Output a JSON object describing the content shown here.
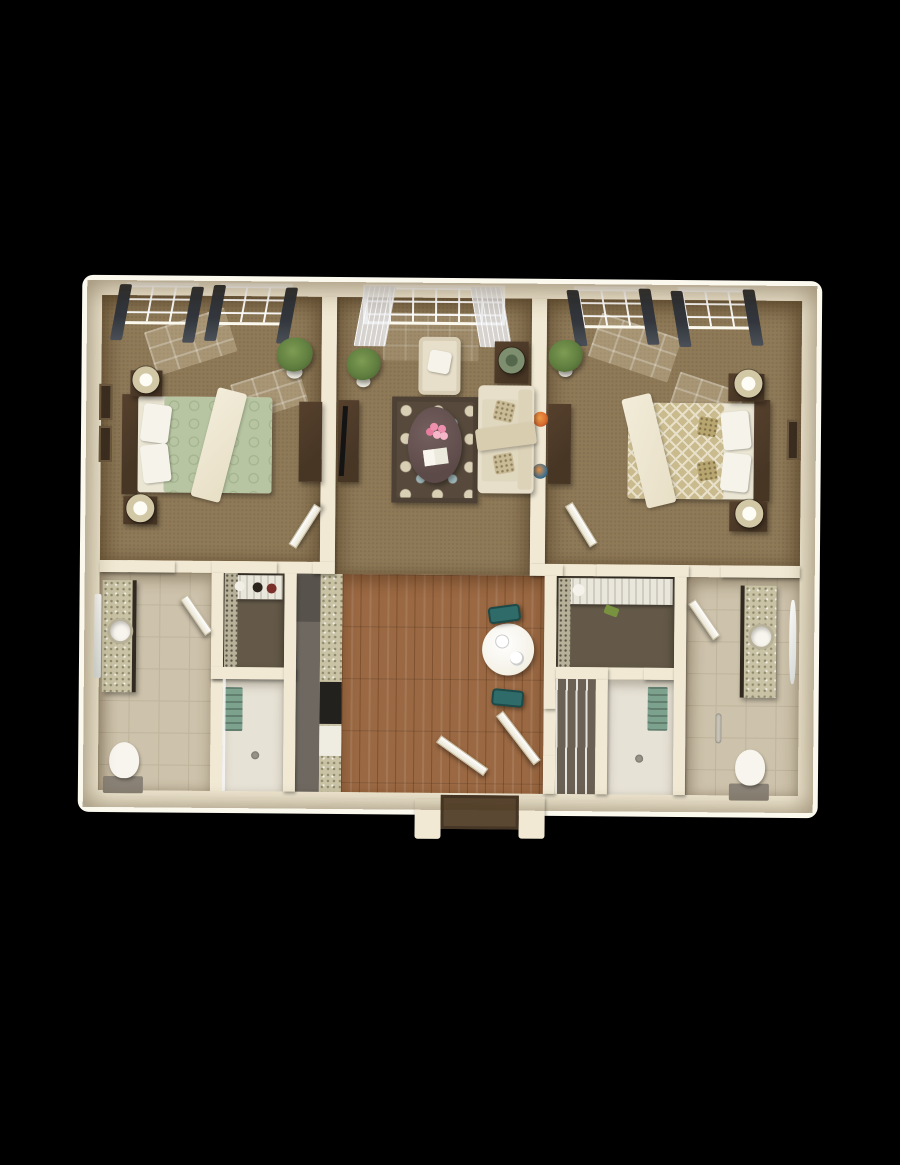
{
  "scene": {
    "type": "3d-overhead-floor-plan-render",
    "description": "Top-down 3D rendering of a two-bedroom, two-bath apartment on a black background: two carpeted bedrooms flank a central living room; below are two bath/closet suites flanking a galley kitchen with wood-floor dining area and front entry",
    "background_color": "#000000",
    "visible_text": []
  },
  "palette": {
    "wall": "#f1e9d3",
    "wall_rim": "#fbf8ee",
    "carpet": "#8f7a58",
    "tile": "#cdc2ab",
    "tile_line": "#bfb49c",
    "wood": "#9a6842",
    "wood_dark": "#7f522f",
    "closet_floor": "#645948",
    "shower_floor": "#e7e2d6",
    "counter_dark": "#6e6860",
    "fridge": "#57524b",
    "granite": "#c9c2a4",
    "granite_dot": "#8f8a6d",
    "cooktop": "#23211e",
    "appliance": "#efece1",
    "bed_green": "#b7c5a2",
    "bed_green_dot": "#a3b38c",
    "bed_tan": "#cabb8e",
    "bed_tan_line": "#e8e0c9",
    "mattress": "#ebe6d4",
    "pillow": "#f6f4ea",
    "throw_cream": "#e8dfc6",
    "dark_wood": "#483625",
    "lamp_shade": "#d3c8a6",
    "rug_base": "#574a3c",
    "rug_cream": "#d9cfb4",
    "rug_blue": "#9fb7ba",
    "rug_border": "#4c4134",
    "sofa_cream": "#e7dfca",
    "cushion": "#e0d7bf",
    "teal": "#2f6b68",
    "table_white": "#f4f1e6",
    "doormat": "#5b4833",
    "towel": "#7ca28e",
    "tank": "#8a8276",
    "porcelain": "#f7f5ed",
    "plant": "#5e7c3e",
    "pot": "#eceadf",
    "sky_top": "#cfe6f2",
    "sky_bot": "#eff8fc",
    "curtain_dark": "#34383e",
    "sheer": "rgba(233,234,238,0.8)",
    "art_a": "#d86a2e",
    "art_b": "#3e6f8e",
    "flower": "#ef8fae",
    "glass": "rgba(255,255,255,0.75)"
  },
  "rooms": [
    {
      "id": "bedroom-left",
      "floor": "carpet",
      "furniture": [
        "queen bed with sage-green patterned duvet, white pillows, cream throw, dark headboard",
        "two dark-wood nightstands with cream drum lamps",
        "two wall frames",
        "potted plant",
        "dresser",
        "two windows with dark curtain panels",
        "swing door"
      ]
    },
    {
      "id": "living-room",
      "floor": "carpet",
      "furniture": [
        "wide window with sheer curtains",
        "cream armchair with pillow",
        "yucca plant",
        "side table with green lamp",
        "media console with flat TV",
        "brown damask area rug (cream and blue motifs)",
        "oval dark coffee table with pink flowers and open book",
        "cream sofa with two patterned pillows and tan throw",
        "two round wall artworks"
      ]
    },
    {
      "id": "bedroom-right",
      "floor": "carpet",
      "furniture": [
        "queen bed with tan trellis-pattern duvet, white pillows, accent pillows, cream throw, dark headboard on right wall",
        "two nightstands with cream drum lamps",
        "potted plant",
        "dresser",
        "wall frame",
        "two windows with dark curtain panels",
        "swing door"
      ]
    },
    {
      "id": "bathroom-left",
      "floor": "tile",
      "furniture": [
        "granite vanity with round white sink",
        "wall mirror",
        "toilet",
        "swing door"
      ]
    },
    {
      "id": "walk-in-closet-left",
      "floor": "dark",
      "furniture": [
        "shelf with shoes and accessories",
        "hanging clothes rail"
      ]
    },
    {
      "id": "shower-left",
      "floor": "light tile",
      "furniture": [
        "green folded towels",
        "floor drain",
        "glass panel"
      ]
    },
    {
      "id": "kitchen",
      "floor": "counter run",
      "furniture": [
        "dark counter band",
        "refrigerator",
        "granite counter",
        "black cooktop",
        "white dishwasher"
      ]
    },
    {
      "id": "dining-entry",
      "floor": "wood planks",
      "furniture": [
        "round white bistro table with place settings",
        "two teal chairs",
        "entry doormat",
        "two white swing doors",
        "entry threshold"
      ]
    },
    {
      "id": "walk-in-closet-right",
      "floor": "dark",
      "furniture": [
        "wire shelf with white hat, black hat, shoes and bottles",
        "hanging clothes rail"
      ]
    },
    {
      "id": "linen-closet-right",
      "floor": "dark",
      "furniture": [
        "wire shelving stack"
      ]
    },
    {
      "id": "shower-right",
      "floor": "light tile",
      "furniture": [
        "green folded towels",
        "floor drain"
      ]
    },
    {
      "id": "bathroom-right",
      "floor": "tile",
      "furniture": [
        "granite vanity with round white sink",
        "oval wall mirror",
        "toilet",
        "swing door"
      ]
    }
  ]
}
